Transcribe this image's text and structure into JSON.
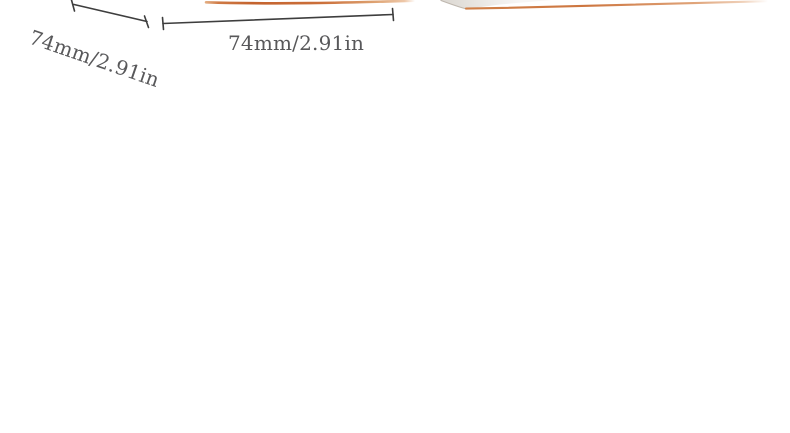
{
  "page": {
    "background_color": "#ffffff"
  },
  "gallery": {
    "left_product_edge_color": "#c4632e",
    "right_product_edge_color": "#cd7640",
    "right_product_corner_color": "#ddd8d2"
  },
  "annotations": {
    "line_color": "#3e3e3e",
    "text_color": "#58585a",
    "depth_dimension": {
      "label": "74mm/2.91in"
    },
    "width_dimension": {
      "label": "74mm/2.91in"
    }
  }
}
